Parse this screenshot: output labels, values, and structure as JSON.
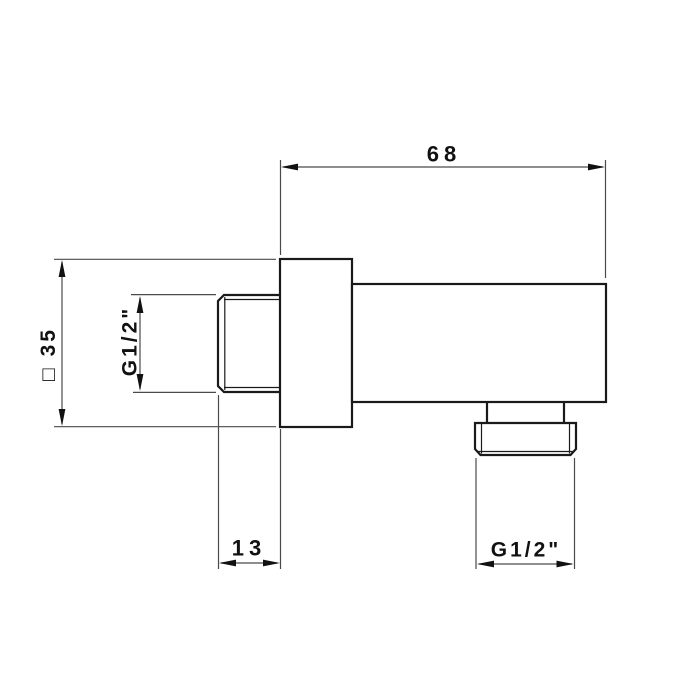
{
  "drawing": {
    "colors": {
      "background": "#ffffff",
      "outline": "#1a1a1a",
      "dimension_lines": "#4a4a4a",
      "text": "#111111"
    },
    "dims": {
      "length": "68",
      "square": "□ 35",
      "inlet_thread": "G1/2\"",
      "projection": "13",
      "outlet_thread": "G1/2\""
    }
  }
}
